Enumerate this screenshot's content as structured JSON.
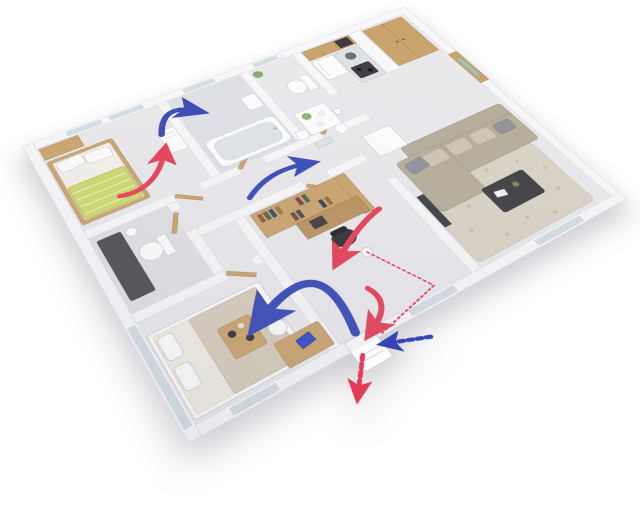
{
  "meta": {
    "kind": "3d-floorplan-render",
    "view": "isometric cutaway of a one-storey apartment",
    "theme": "fresh-air heat-recovery ventilation system with supply and exhaust airflow arrows"
  },
  "colors": {
    "background": "#ffffff",
    "wall": "#f8f8fa",
    "wall_edge": "#dcdce2",
    "floor": "#e9e9ec",
    "floor_dark": "#dfe0e5",
    "glass": "#d3dde2",
    "wood": "#c9a26a",
    "wood_dark": "#a9834f",
    "supply": "#3346b4",
    "exhaust": "#e63b54",
    "bed_green": "#ccd96a",
    "sofa_beige": "#b5ab97",
    "rug": "#d9d2c4",
    "appliance_dark": "#3a3a3e",
    "laptop_blue": "#2d46c8"
  },
  "rooms": [
    {
      "name": "bedroom-1",
      "furniture": [
        "double bed with green striped duvet",
        "wood wardrobe",
        "two windows",
        "wall ventilation unit"
      ]
    },
    {
      "name": "bathroom-with-tub",
      "furniture": [
        "bathtub",
        "wash basin",
        "window"
      ]
    },
    {
      "name": "wc",
      "furniture": [
        "toilet",
        "plant",
        "window"
      ]
    },
    {
      "name": "kitchen",
      "furniture": [
        "upper cabinets",
        "fridge",
        "sink counter",
        "stove"
      ]
    },
    {
      "name": "dining-nook",
      "furniture": [
        "white table with flowers",
        "two chairs"
      ]
    },
    {
      "name": "entrance-hall",
      "furniture": [
        "double-door wardrobe",
        "front door with glass inset"
      ]
    },
    {
      "name": "living-room",
      "furniture": [
        "L-shaped beige sofa",
        "black coffee table",
        "floral rug",
        "white sideboard",
        "tv panel",
        "window"
      ]
    },
    {
      "name": "hallway",
      "furniture": [
        "wooden interior doors",
        "radiator grille"
      ]
    },
    {
      "name": "bathroom-2",
      "furniture": [
        "toilet",
        "dark shower vanity",
        "ceiling light"
      ]
    },
    {
      "name": "bedroom-2",
      "furniture": [
        "bed with breakfast tray",
        "desk with white chair",
        "laptop",
        "glass wall",
        "window"
      ]
    },
    {
      "name": "study",
      "furniture": [
        "wood bookshelf wall unit",
        "desk",
        "black office chair",
        "ceiling light",
        "window"
      ]
    }
  ],
  "ventilation": {
    "supply_color": "#3346b4",
    "exhaust_color": "#e63b54",
    "arrows": [
      {
        "id": "bedroom1-exhaust-to-unit",
        "kind": "exhaust",
        "style": "solid curve"
      },
      {
        "id": "bedroom1-supply-over-wall",
        "kind": "supply",
        "style": "solid curve"
      },
      {
        "id": "hallway-supply",
        "kind": "supply",
        "style": "solid curve"
      },
      {
        "id": "study-exhaust",
        "kind": "exhaust",
        "style": "solid curve"
      },
      {
        "id": "bedroom2-supply-from-unit",
        "kind": "supply",
        "style": "solid curve"
      },
      {
        "id": "exhaust-into-wall-unit",
        "kind": "exhaust",
        "style": "solid curve"
      },
      {
        "id": "duct-line",
        "kind": "exhaust",
        "style": "dotted line"
      },
      {
        "id": "outdoor-exhaust-out",
        "kind": "exhaust",
        "style": "dashed chevron"
      },
      {
        "id": "outdoor-fresh-intake",
        "kind": "supply",
        "style": "dashed chevron"
      }
    ],
    "units": [
      {
        "id": "bedroom-wall-unit",
        "location": "bedroom-1 interior wall"
      },
      {
        "id": "exterior-hrv-unit",
        "location": "outside bottom facade"
      }
    ]
  },
  "lights": {
    "ceiling_light_count": 4
  }
}
